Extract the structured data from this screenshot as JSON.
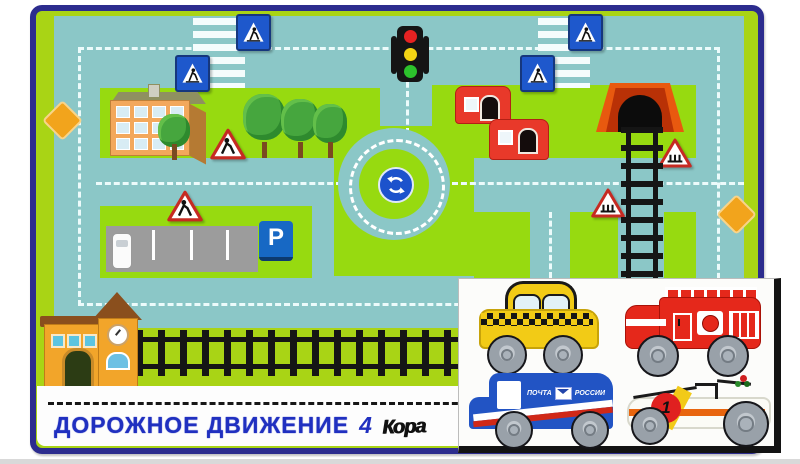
{
  "title": {
    "text": "ДОРОЖНОЕ ДВИЖЕНИЕ",
    "issue": "4",
    "brand": "Кора"
  },
  "mat": {
    "parking_sign": "P",
    "signs": [
      "pedestrian-crossing (blue square, 4x)",
      "children-warning triangle (2x)",
      "railway-crossing triangle (2x)",
      "roundabout circular sign",
      "parking P sign",
      "orange diamond main-road sign (2x)"
    ],
    "features": [
      "traffic-light",
      "roundabout",
      "zebra-crossing (2x)",
      "railway with tunnel",
      "railway station with clock",
      "apartment-building",
      "red houses (2x)",
      "parking-lot with car",
      "trees",
      "dashed road markings"
    ]
  },
  "cutout_panel": {
    "vehicles": [
      {
        "name": "taxi",
        "color": "#f2cb16"
      },
      {
        "name": "fire-truck",
        "color": "#e5281b"
      },
      {
        "name": "mail-truck",
        "color": "#2254c4",
        "label_left": "ПОЧТА",
        "label_right": "РОССИИ"
      },
      {
        "name": "race-car",
        "color": "#ffffff",
        "number": "1"
      }
    ]
  },
  "colors": {
    "frame": "#2c2c8e",
    "margin_green": "#a9d415",
    "road_teal": "#8bc7c7",
    "grass_green": "#97da10",
    "dash_white": "#ecfbfb",
    "sign_blue": "#1e58cc",
    "warning_red": "#cc2222",
    "diamond_orange": "#f2a41c",
    "title_blue": "#2030c0"
  }
}
